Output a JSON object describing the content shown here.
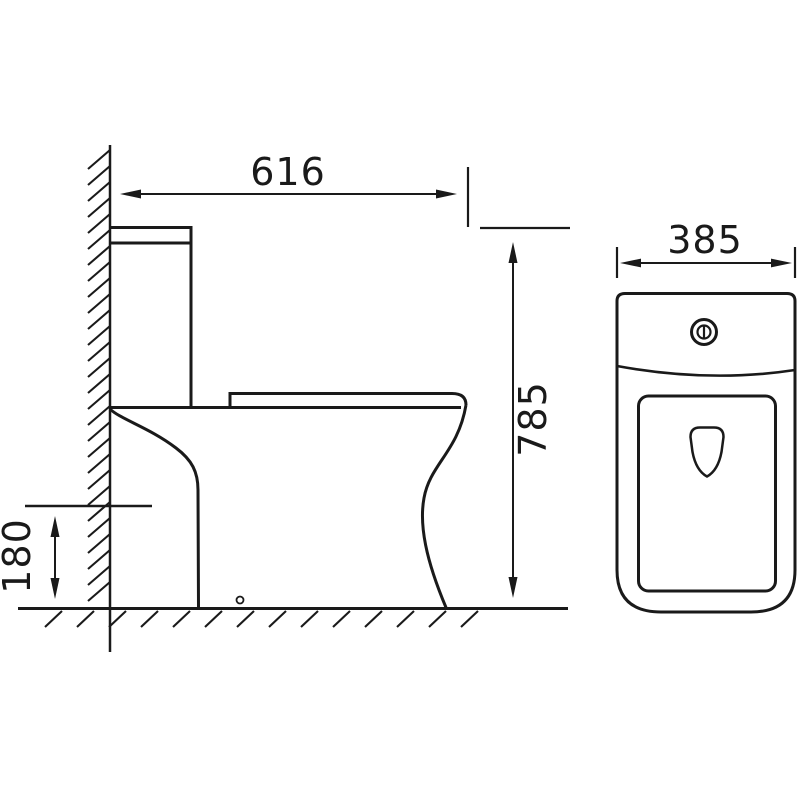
{
  "drawing": {
    "type": "technical-dimension-drawing",
    "subject": "close-coupled toilet, side view and front view",
    "colors": {
      "line": "#1a1a1a",
      "background": "#ffffff"
    },
    "dimensions": {
      "side_depth": "616",
      "total_height": "785",
      "outlet_height": "180",
      "front_width": "385"
    }
  }
}
